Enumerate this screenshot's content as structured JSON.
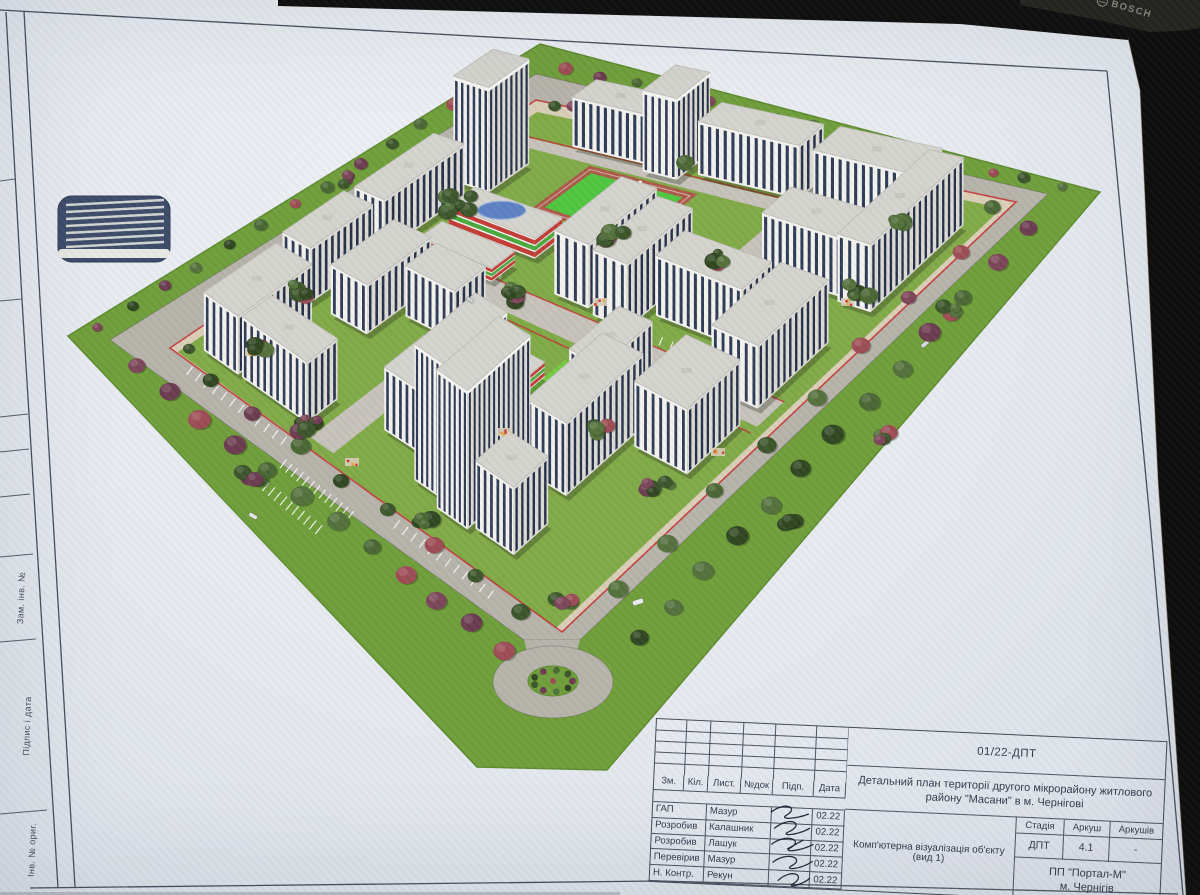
{
  "device": {
    "brand": "BOSCH"
  },
  "sheet": {
    "side_labels": [
      "Зам. інв. №",
      "Підпис і дата",
      "Інв. № ориг."
    ],
    "stamp": {
      "doc_code": "01/22-ДПТ",
      "title_line1": "Детальний план території другого мікрорайону житлового",
      "title_line2": "району \"Масани\" в м. Чернігові",
      "rev_headers": [
        "Зм.",
        "Кіл.",
        "Лист.",
        "№док",
        "Підп.",
        "Дата"
      ],
      "signers": [
        {
          "role": "ГАП",
          "name": "Мазур",
          "date": "02.22"
        },
        {
          "role": "Розробив",
          "name": "Калашник",
          "date": "02.22"
        },
        {
          "role": "Розробив",
          "name": "Лашук",
          "date": "02.22"
        },
        {
          "role": "Перевірив",
          "name": "Мазур",
          "date": "02.22"
        },
        {
          "role": "Н. Контр.",
          "name": "Рекун",
          "date": "02.22"
        }
      ],
      "stage": {
        "headers": [
          "Стадія",
          "Аркуш",
          "Аркушів"
        ],
        "values": [
          "ДПТ",
          "4.1",
          "-"
        ]
      },
      "view_label": "Комп'ютерна візуалізація об'єкту (вид 1)",
      "company": [
        "ПП \"Портал-М\"",
        "м. Чернігів"
      ]
    }
  },
  "render": {
    "colors": {
      "lawn": "#6f9e39",
      "lawnEdge": "#5d8a2e",
      "road": "#b6b2aa",
      "roadLight": "#c6c2ba",
      "walk": "#d9cdb6",
      "innerGrass": "#7fa945",
      "faceL": "#f3f2ee",
      "faceR": "#dbdad4",
      "roof": "#d4d3cd",
      "roofEdge": "#bcbbb5",
      "win": "#2d3a55",
      "winDark": "#232e47",
      "red": "#c03434",
      "field": "#4ec63e",
      "track": "#aa5a48",
      "brightLawn": "#72cc3c",
      "schoolRed": "#c23a34",
      "schoolGreen": "#47a83a",
      "blueRoof": "#5b80c2",
      "garage": "#3b4a68",
      "shadow": "rgba(35,45,25,0.32)",
      "treeGreens": [
        "#3a5429",
        "#2e451f",
        "#52703a",
        "#486632"
      ],
      "treePurples": [
        "#6b3a4e",
        "#9c4a52",
        "#7c4458"
      ]
    },
    "grid": {
      "T": [
        537,
        112
      ],
      "R": [
        1002,
        208
      ],
      "B": [
        556,
        628
      ],
      "L": [
        178,
        352
      ]
    },
    "site": {
      "lawn": [
        [
          540,
          44
        ],
        [
          1100,
          192
        ],
        [
          607,
          770
        ],
        [
          477,
          767
        ],
        [
          68,
          336
        ]
      ],
      "roadOuter": [
        [
          536,
          74
        ],
        [
          1048,
          194
        ],
        [
          580,
          640
        ],
        [
          524,
          640
        ],
        [
          110,
          340
        ]
      ],
      "roadInner": [
        [
          536,
          100
        ],
        [
          1016,
          202
        ],
        [
          562,
          632
        ],
        [
          170,
          348
        ]
      ],
      "inner": [
        [
          537,
          112
        ],
        [
          1002,
          208
        ],
        [
          556,
          628
        ],
        [
          178,
          352
        ]
      ]
    },
    "roundabout": {
      "cx": 553,
      "cy": 682,
      "rx": 60,
      "ry": 36,
      "irx": 25,
      "iry": 15
    },
    "garage": {
      "x": 58,
      "y": 196,
      "w": 112,
      "h": 66
    },
    "field": {
      "r": [
        0.22,
        0.13,
        0.44,
        0.27
      ]
    },
    "lawnPatch": {
      "r": [
        0.56,
        0.57,
        0.65,
        0.66
      ]
    },
    "roads": [
      {
        "s": [
          0.02,
          0.98
        ],
        "t": [
          0.47,
          0.53
        ]
      },
      {
        "s": [
          0.04,
          0.96
        ],
        "t": [
          0.085,
          0.115
        ]
      },
      {
        "s": [
          0.63,
          0.69
        ],
        "t": [
          0.02,
          0.3
        ]
      },
      {
        "s": [
          0.33,
          0.39
        ],
        "t": [
          0.55,
          0.98
        ]
      }
    ],
    "redlines": [
      [
        [
          0.02,
          0.47
        ],
        [
          0.98,
          0.47
        ]
      ],
      [
        [
          0.02,
          0.545
        ],
        [
          0.98,
          0.545
        ]
      ],
      [
        [
          0.04,
          0.082
        ],
        [
          0.96,
          0.082
        ]
      ]
    ],
    "dashes": [
      {
        "a": [
          0.08,
          0.455
        ],
        "b": [
          0.3,
          0.455
        ],
        "n": 10,
        "len": 9
      },
      {
        "a": [
          0.55,
          0.455
        ],
        "b": [
          0.75,
          0.455
        ],
        "n": 9,
        "len": 9
      },
      {
        "a": [
          0.08,
          0.535
        ],
        "b": [
          0.3,
          0.535
        ],
        "n": 10,
        "len": 9
      },
      {
        "a": [
          0.6,
          0.535
        ],
        "b": [
          0.8,
          0.535
        ],
        "n": 9,
        "len": 9
      },
      {
        "a": [
          0.15,
          -0.02
        ],
        "b": [
          0.45,
          -0.02
        ],
        "n": 14,
        "len": 9
      },
      {
        "a": [
          -0.025,
          0.2
        ],
        "b": [
          -0.025,
          0.5
        ],
        "n": 12,
        "len": 9
      },
      {
        "a": [
          0.05,
          1.02
        ],
        "b": [
          0.3,
          1.02
        ],
        "n": 12,
        "len": 10
      },
      {
        "a": [
          0.6,
          1.02
        ],
        "b": [
          0.85,
          1.02
        ],
        "n": 12,
        "len": 10
      },
      {
        "a": [
          0.34,
          1.06
        ],
        "b": [
          0.52,
          1.06
        ],
        "n": 13,
        "len": 11
      },
      {
        "a": [
          0.34,
          1.12
        ],
        "b": [
          0.5,
          1.12
        ],
        "n": 11,
        "len": 11
      }
    ],
    "buildings": [
      {
        "r": [
          0.03,
          0.16,
          0.11,
          0.27
        ],
        "fl": 16,
        "ty": "t"
      },
      {
        "r": [
          0.01,
          0.3,
          0.08,
          0.52
        ],
        "fl": 8,
        "ty": "r"
      },
      {
        "r": [
          0.01,
          0.55,
          0.08,
          0.72
        ],
        "fl": 8,
        "ty": "r"
      },
      {
        "r": [
          0.03,
          0.76,
          0.12,
          0.96
        ],
        "fl": 8,
        "ty": "r"
      },
      {
        "r": [
          0.13,
          0.88,
          0.3,
          0.96
        ],
        "fl": 8,
        "ty": "r"
      },
      {
        "r": [
          0.14,
          0.015,
          0.3,
          0.08
        ],
        "fl": 8,
        "ty": "r"
      },
      {
        "r": [
          0.31,
          0.015,
          0.385,
          0.1
        ],
        "fl": 12,
        "ty": "t"
      },
      {
        "r": [
          0.41,
          0.015,
          0.63,
          0.075
        ],
        "fl": 8,
        "ty": "r"
      },
      {
        "r": [
          0.67,
          0.02,
          0.89,
          0.085
        ],
        "fl": 8,
        "ty": "r"
      },
      {
        "r": [
          0.89,
          0.05,
          0.965,
          0.26
        ],
        "fl": 9,
        "ty": "r"
      },
      {
        "r": [
          0.71,
          0.18,
          0.89,
          0.25
        ],
        "fl": 8,
        "ty": "r"
      },
      {
        "r": [
          0.42,
          0.28,
          0.5,
          0.45
        ],
        "fl": 9,
        "ty": "r"
      },
      {
        "r": [
          0.52,
          0.3,
          0.6,
          0.46
        ],
        "fl": 9,
        "ty": "r"
      },
      {
        "r": [
          0.62,
          0.34,
          0.82,
          0.41
        ],
        "fl": 8,
        "ty": "r"
      },
      {
        "r": [
          0.66,
          0.54,
          0.74,
          0.66
        ],
        "fl": 8,
        "ty": "r"
      },
      {
        "r": [
          0.84,
          0.34,
          0.95,
          0.5
        ],
        "fl": 8,
        "ty": "r"
      },
      {
        "r": [
          0.13,
          0.55,
          0.22,
          0.72
        ],
        "fl": 7,
        "ty": "r"
      },
      {
        "r": [
          0.24,
          0.56,
          0.36,
          0.64
        ],
        "fl": 7,
        "ty": "r"
      },
      {
        "r": [
          0.42,
          0.78,
          0.52,
          0.88
        ],
        "fl": 8,
        "ty": "r"
      },
      {
        "r": [
          0.55,
          0.78,
          0.63,
          0.93
        ],
        "fl": 16,
        "ty": "t"
      },
      {
        "r": [
          0.63,
          0.8,
          0.71,
          0.95
        ],
        "fl": 16,
        "ty": "t"
      },
      {
        "r": [
          0.7,
          0.62,
          0.8,
          0.8
        ],
        "fl": 9,
        "ty": "r"
      },
      {
        "r": [
          0.82,
          0.54,
          0.95,
          0.66
        ],
        "fl": 8,
        "ty": "r"
      },
      {
        "r": [
          0.72,
          0.86,
          0.82,
          0.94
        ],
        "fl": 8,
        "ty": "r"
      },
      {
        "r": [
          0.12,
          0.32,
          0.32,
          0.39
        ],
        "fl": 3,
        "ty": "s"
      },
      {
        "r": [
          0.13,
          0.42,
          0.3,
          0.48
        ],
        "fl": 2,
        "ty": "s"
      },
      {
        "r": [
          0.42,
          0.62,
          0.56,
          0.73
        ],
        "fl": 2,
        "ty": "k"
      }
    ],
    "treeRowsBack": [
      {
        "a": [
          520,
          66
        ],
        "b": [
          100,
          326
        ],
        "n": 14,
        "r": 6
      },
      {
        "a": [
          565,
          68
        ],
        "b": [
          1062,
          188
        ],
        "n": 15,
        "r": 6
      },
      {
        "a": [
          552,
          104
        ],
        "b": [
          190,
          348
        ],
        "n": 11,
        "r": 7
      },
      {
        "a": [
          570,
          108
        ],
        "b": [
          990,
          208
        ],
        "n": 11,
        "r": 7
      }
    ],
    "treeRowsFront": [
      {
        "a": [
          135,
          366
        ],
        "b": [
          505,
          650
        ],
        "n": 12,
        "r": 10
      },
      {
        "a": [
          210,
          380
        ],
        "b": [
          520,
          610
        ],
        "n": 8,
        "r": 9
      },
      {
        "a": [
          1030,
          230
        ],
        "b": [
          640,
          640
        ],
        "n": 13,
        "r": 10
      },
      {
        "a": [
          960,
          250
        ],
        "b": [
          620,
          590
        ],
        "n": 8,
        "r": 9
      }
    ],
    "treeClusters": [
      [
        455,
        205,
        8,
        32
      ],
      [
        610,
        235,
        7,
        30
      ],
      [
        520,
        295,
        6,
        26
      ],
      [
        300,
        290,
        5,
        22
      ],
      [
        260,
        350,
        4,
        20
      ],
      [
        720,
        260,
        5,
        24
      ],
      [
        860,
        290,
        5,
        22
      ],
      [
        950,
        310,
        4,
        18
      ],
      [
        310,
        425,
        6,
        24
      ],
      [
        250,
        475,
        5,
        22
      ],
      [
        660,
        485,
        6,
        26
      ],
      [
        785,
        520,
        5,
        22
      ],
      [
        565,
        600,
        4,
        20
      ],
      [
        880,
        435,
        4,
        18
      ],
      [
        420,
        525,
        5,
        22
      ],
      [
        600,
        430,
        4,
        18
      ],
      [
        350,
        180,
        4,
        18
      ],
      [
        680,
        160,
        4,
        16
      ],
      [
        900,
        220,
        4,
        16
      ]
    ],
    "playgrounds": [
      [
        300,
        292
      ],
      [
        600,
        302
      ],
      [
        848,
        302
      ],
      [
        505,
        432
      ],
      [
        718,
        452
      ],
      [
        352,
        462
      ],
      [
        252,
        352
      ]
    ],
    "cars": [
      [
        638,
        602,
        11,
        5,
        "#ececee",
        -18
      ],
      [
        925,
        344,
        9,
        4,
        "#d8dadc",
        -40
      ],
      [
        253,
        516,
        9,
        4,
        "#e8e8e8",
        32
      ],
      [
        470,
        300,
        8,
        4,
        "#d0d2d4",
        30
      ],
      [
        795,
        470,
        8,
        4,
        "#c94444",
        -40
      ]
    ]
  }
}
